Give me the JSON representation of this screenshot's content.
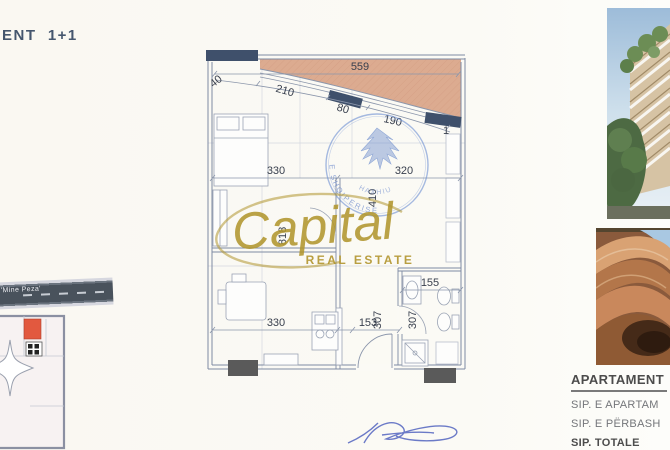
{
  "header": {
    "title": "ENT  1+1"
  },
  "plan": {
    "dims": {
      "total_top": "559",
      "edge_left": "40",
      "seg1": "210",
      "seg2": "80",
      "seg3": "190",
      "seg4": "1",
      "bedroom_w": "330",
      "kitchen_w": "320",
      "mid_h": "410",
      "left_h": "818",
      "living_w": "330",
      "hall_w": "153",
      "hall_h": "307",
      "bath_h": "307",
      "bath_w": "155"
    },
    "stamp": {
      "arc_text": "E SHQIPERISE",
      "name_text": "HAXHIU"
    }
  },
  "watermark": {
    "name": "Capital",
    "tagline": "REAL ESTATE",
    "color": "#b1952e"
  },
  "site_plan": {
    "street_label": "'Mine Peza'",
    "unit_color": "#e2593f"
  },
  "summary": {
    "heading": "APARTAMENT",
    "row_apartment": "SIP. E APARTAM",
    "row_shared": "SIP. E PËRBASH",
    "row_total": "SIP. TOTALE"
  },
  "colors": {
    "balcony": "#dcab90",
    "wall_dark": "#3f506b",
    "stamp_blue": "#5f82c8",
    "gold": "#b1952e"
  }
}
